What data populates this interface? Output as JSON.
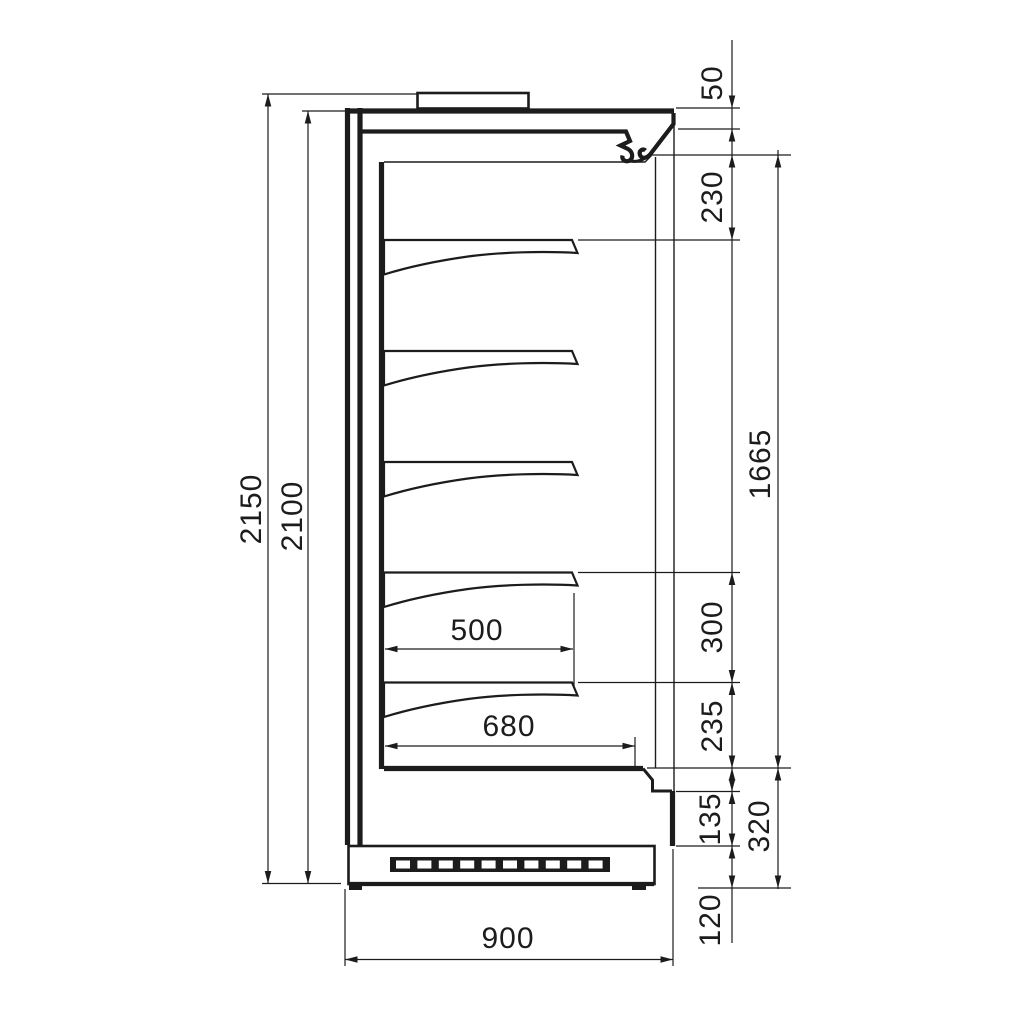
{
  "drawing": {
    "title": "refrigerated-display-cabinet-side-section",
    "line_color": "#1c1c1c",
    "background": "#ffffff",
    "dimensions": {
      "overall_height": "2150",
      "body_height": "2100",
      "canopy_front_lip": "50",
      "top_clearance": "230",
      "display_opening_height": "1665",
      "lower_shelf_spacing": "300",
      "bottom_shelf_clearance": "235",
      "shelf_depth": "500",
      "base_well_depth": "680",
      "kick_step_height": "135",
      "base_section_height": "320",
      "plinth_height": "120",
      "overall_depth": "900"
    }
  }
}
